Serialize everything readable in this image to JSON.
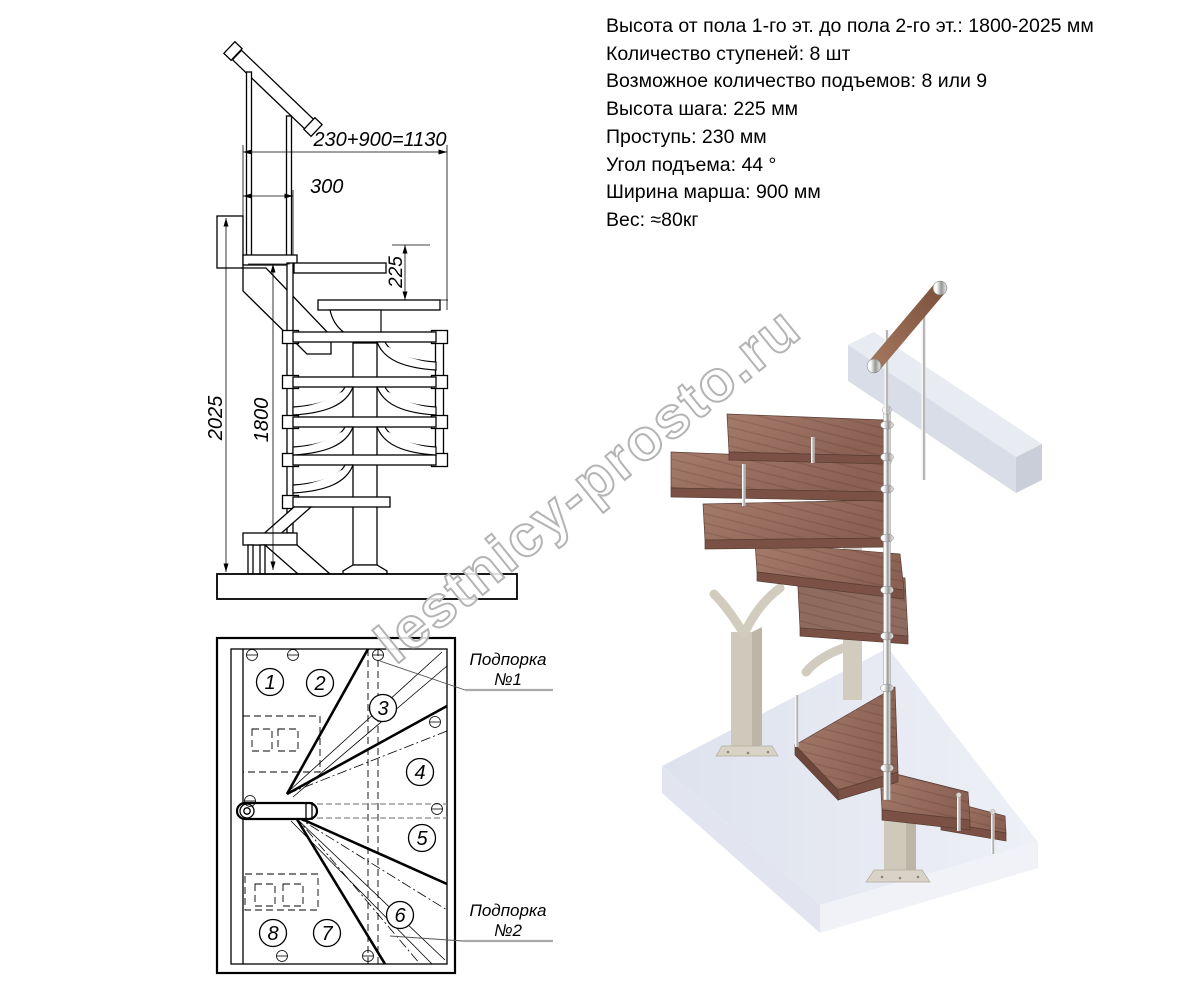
{
  "specs": {
    "lines": [
      "Высота от пола 1-го эт. до пола 2-го эт.: 1800-2025 мм",
      "Количество ступеней: 8 шт",
      "Возможное количество подъемов: 8 или 9",
      "Высота шага: 225 мм",
      "Проступь: 230 мм",
      "Угол подъема: 44 °",
      "Ширина марша: 900 мм",
      "Вес: ≈80кг"
    ]
  },
  "side_view": {
    "dim_total_run": "230+900=1130",
    "dim_landing": "300",
    "dim_rise": "225",
    "dim_total_height": "2025",
    "dim_rail_height": "1800"
  },
  "plan_view": {
    "step_numbers": [
      "1",
      "2",
      "3",
      "4",
      "5",
      "6",
      "7",
      "8"
    ],
    "support1_title": "Подпорка",
    "support1_num": "№1",
    "support2_title": "Подпорка",
    "support2_num": "№2"
  },
  "watermark": {
    "text": "lestnicy-prosto.ru"
  },
  "colors": {
    "line": "#000000",
    "wood_top": "#9a7164",
    "wood_side": "#7a5144",
    "slab": "#e9ecf3",
    "beam": "#e9ebf3",
    "column_beige": "#cfc9bb",
    "chrome": "#cfcfcf",
    "watermark_outline": "#b4b4b4"
  }
}
